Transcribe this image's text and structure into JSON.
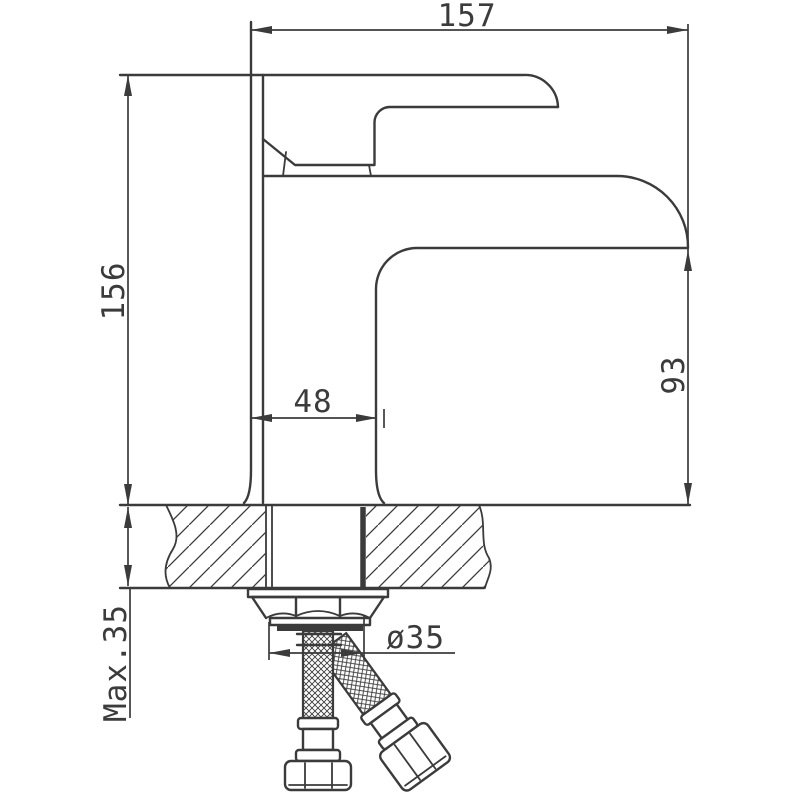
{
  "drawing": {
    "title": "Basin mixer faucet installation drawing",
    "view": "side elevation with countertop mounting cross-section",
    "units": "mm",
    "line_color": "#3b3b3b",
    "background_color": "#ffffff",
    "dimensions": {
      "overall_width": {
        "label": "157",
        "value": 157,
        "orientation": "horizontal",
        "position": "top"
      },
      "overall_height": {
        "label": "156",
        "value": 156,
        "orientation": "vertical",
        "position": "left"
      },
      "spout_height": {
        "label": "93",
        "value": 93,
        "orientation": "vertical",
        "position": "right"
      },
      "body_width": {
        "label": "48",
        "value": 48,
        "orientation": "horizontal",
        "position": "center"
      },
      "max_deck_thickness": {
        "label": "Max.35",
        "value": 35,
        "orientation": "vertical",
        "position": "bottom-left"
      },
      "mounting_hole_diameter": {
        "label": "ø35",
        "value": 35,
        "orientation": "horizontal",
        "position": "bottom-center"
      }
    },
    "parts": [
      "lever-handle",
      "spout-body",
      "countertop-cross-section",
      "mounting-shank",
      "washer",
      "mounting-hex-nut",
      "braided-supply-hose-vertical",
      "braided-supply-hose-diagonal",
      "hose-connection-nuts"
    ]
  }
}
